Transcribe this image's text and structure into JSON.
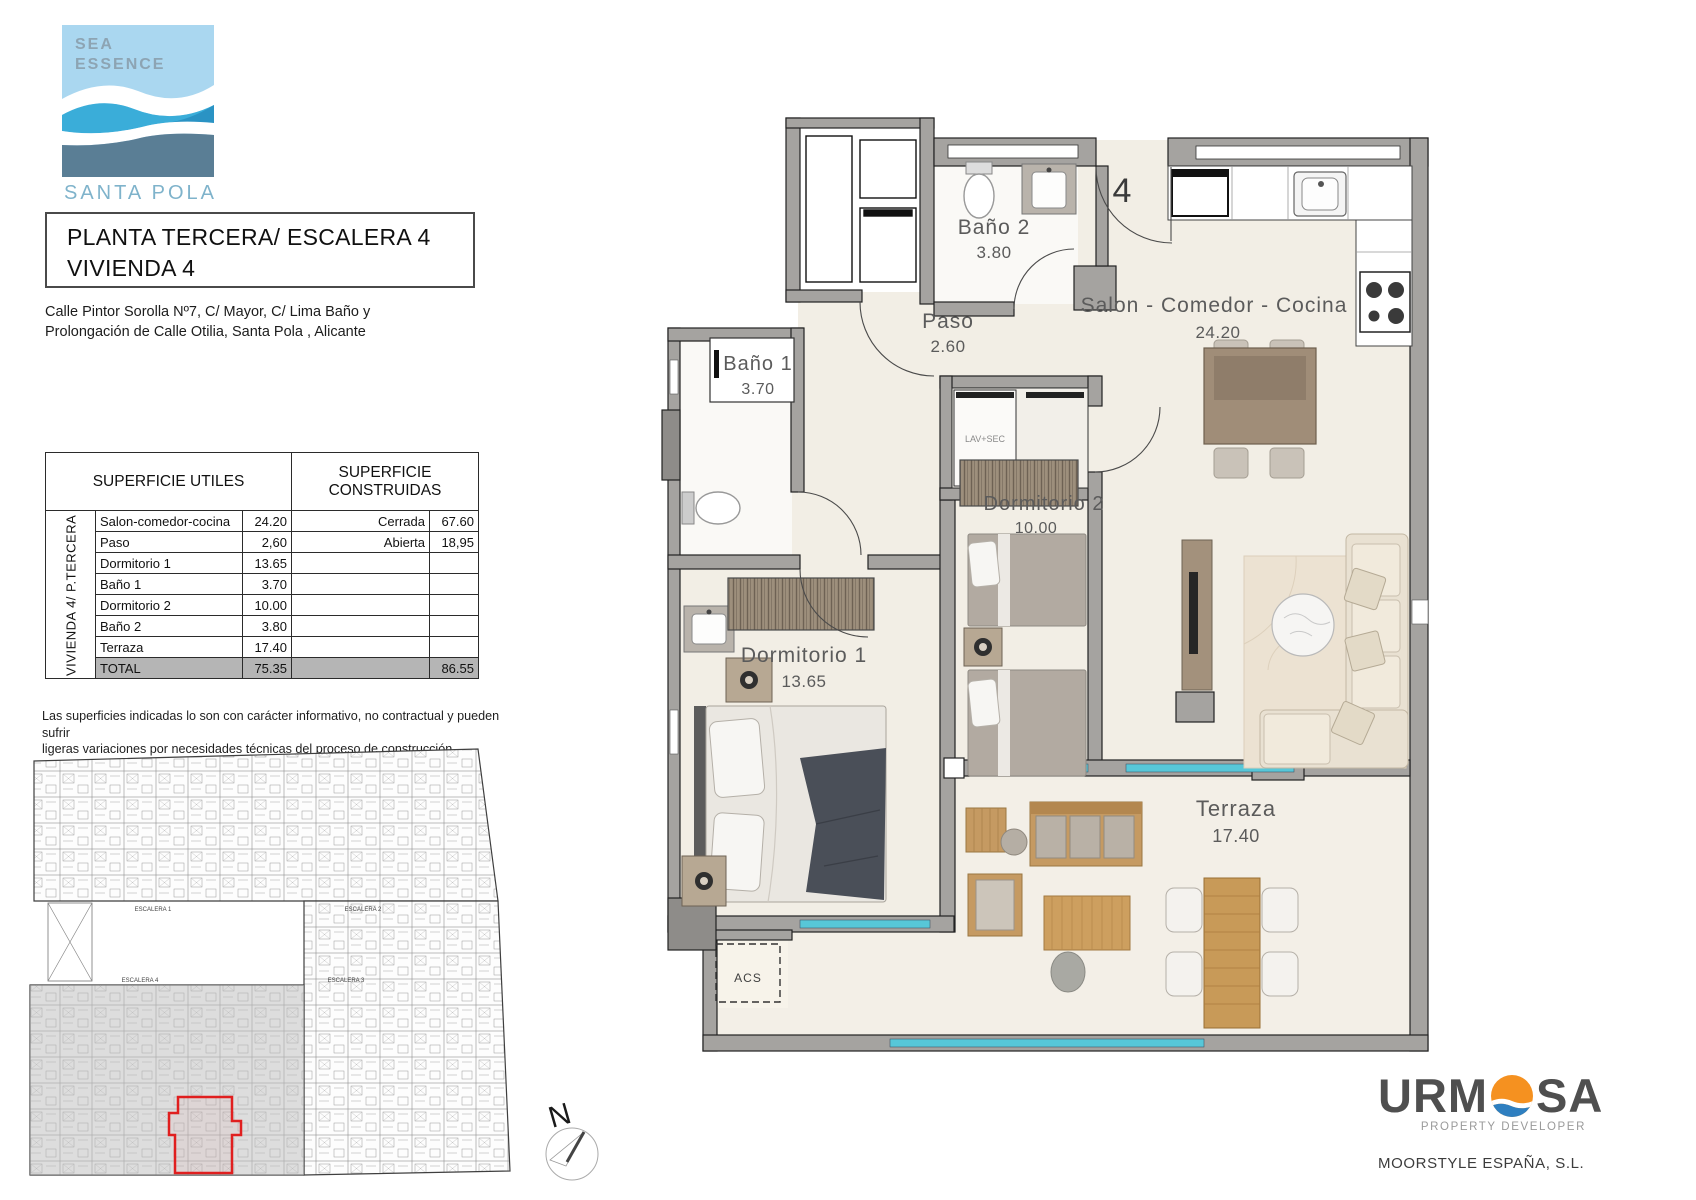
{
  "logo": {
    "line1": "SEA",
    "line2": "ESSENCE",
    "location": "SANTA POLA"
  },
  "title": {
    "line1": "PLANTA TERCERA/ ESCALERA 4",
    "line2": "VIVIENDA 4"
  },
  "address": {
    "line1": "Calle Pintor Sorolla Nº7, C/ Mayor, C/ Lima Baño y",
    "line2": "Prolongación de Calle Otilia, Santa Pola , Alicante"
  },
  "table": {
    "header_left": "SUPERFICIE UTILES",
    "header_right": "SUPERFICIE CONSTRUIDAS",
    "side_label": "VIVIENDA 4/ P.TERCERA",
    "rows": [
      {
        "name": "Salon-comedor-cocina",
        "value": "24.20",
        "cons_label": "Cerrada",
        "cons_value": "67.60"
      },
      {
        "name": "Paso",
        "value": "2,60",
        "cons_label": "Abierta",
        "cons_value": "18,95"
      },
      {
        "name": "Dormitorio 1",
        "value": "13.65",
        "cons_label": "",
        "cons_value": ""
      },
      {
        "name": "Baño 1",
        "value": "3.70",
        "cons_label": "",
        "cons_value": ""
      },
      {
        "name": "Dormitorio 2",
        "value": "10.00",
        "cons_label": "",
        "cons_value": ""
      },
      {
        "name": "Baño 2",
        "value": "3.80",
        "cons_label": "",
        "cons_value": ""
      },
      {
        "name": "Terraza",
        "value": "17.40",
        "cons_label": "",
        "cons_value": ""
      },
      {
        "name": "TOTAL",
        "value": "75.35",
        "cons_label": "",
        "cons_value": "86.55"
      }
    ]
  },
  "disclaimer": {
    "line1": "Las superficies indicadas lo son con carácter informativo, no contractual y pueden sufrir",
    "line2": "ligeras variaciones por necesidades técnicas del proceso de construcción."
  },
  "floorplan": {
    "unit_number": "4",
    "rooms": [
      {
        "name": "Baño 2",
        "area": "3.80"
      },
      {
        "name": "Paso",
        "area": "2.60"
      },
      {
        "name": "Salon - Comedor - Cocina",
        "area": "24.20"
      },
      {
        "name": "Baño 1",
        "area": "3.70"
      },
      {
        "name": "Dormitorio 2",
        "area": "10.00"
      },
      {
        "name": "Dormitorio 1",
        "area": "13.65"
      },
      {
        "name": "Terraza",
        "area": "17.40"
      }
    ],
    "annotations": {
      "lavsec": "LAV+SEC",
      "acs": "ACS"
    }
  },
  "overview": {
    "labels": [
      "ESCALERA 1",
      "ESCALERA 2",
      "ESCALERA 4",
      "ESCALERA 3"
    ]
  },
  "compass": {
    "label": "N"
  },
  "developer": {
    "name_part1": "URM",
    "name_part2": "SA",
    "tagline": "PROPERTY DEVELOPER",
    "company": "MOORSTYLE ESPAÑA, S.L."
  },
  "colors": {
    "window_cyan": "#57c7d8",
    "wall_gray": "#a5a3a0",
    "total_row_gray": "#b5b5b5",
    "highlight_red": "#e01f1f",
    "logo_light_blue": "#aad7f0",
    "logo_mid_blue": "#3aadd9",
    "logo_dark_blue": "#5a7e95",
    "urmosa_orange": "#f59120",
    "urmosa_blue": "#2e7fc0"
  }
}
